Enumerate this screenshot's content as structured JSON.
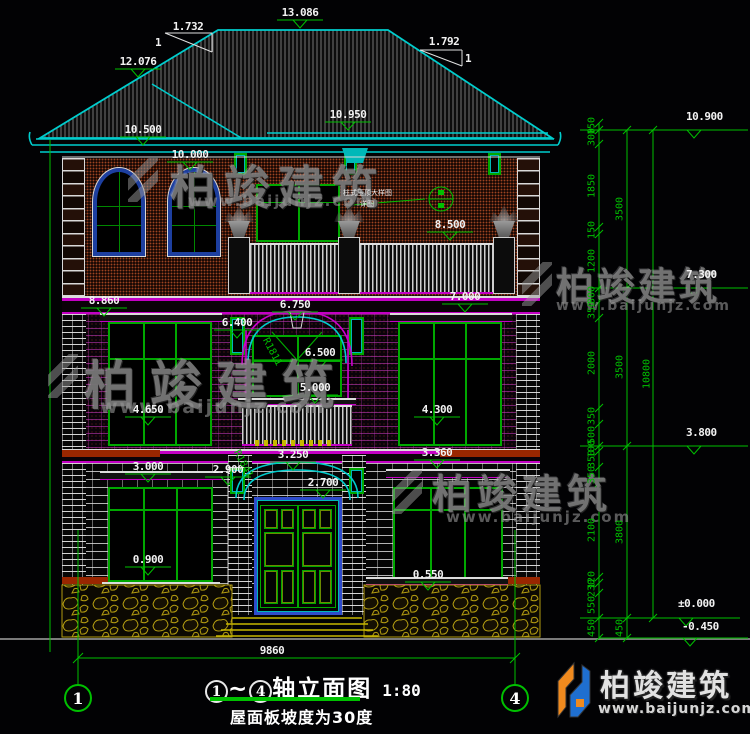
{
  "colors": {
    "cad_green": "#00c000",
    "cyan": "#00cdcd",
    "magenta": "#cc00cc",
    "window_green": "#00a800",
    "frame_blue": "#2e4bcc",
    "red_band": "#992600",
    "step_yellow": "#c8b800",
    "logo_blue": "#1f6fd0",
    "logo_orange": "#f08a1e"
  },
  "roof": {
    "slope_left_rise": "1.732",
    "slope_left_run": "1",
    "slope_right_rise": "1.792",
    "slope_right_run": "1"
  },
  "elevations": [
    {
      "label": "13.086",
      "x": 300,
      "y": 6
    },
    {
      "label": "12.076",
      "x": 138,
      "y": 55
    },
    {
      "label": "10.950",
      "x": 348,
      "y": 108
    },
    {
      "label": "10.500",
      "x": 143,
      "y": 123
    },
    {
      "label": "10.000",
      "x": 190,
      "y": 148
    },
    {
      "label": "8.500",
      "x": 450,
      "y": 218
    },
    {
      "label": "8.860",
      "x": 104,
      "y": 294
    },
    {
      "label": "6.750",
      "x": 295,
      "y": 298
    },
    {
      "label": "7.000",
      "x": 465,
      "y": 290
    },
    {
      "label": "6.400",
      "x": 237,
      "y": 316
    },
    {
      "label": "6.500",
      "x": 320,
      "y": 346
    },
    {
      "label": "5.000",
      "x": 315,
      "y": 381
    },
    {
      "label": "4.650",
      "x": 148,
      "y": 403
    },
    {
      "label": "4.300",
      "x": 437,
      "y": 403
    },
    {
      "label": "3.000",
      "x": 148,
      "y": 460
    },
    {
      "label": "2.900",
      "x": 228,
      "y": 463
    },
    {
      "label": "3.250",
      "x": 293,
      "y": 448
    },
    {
      "label": "2.700",
      "x": 323,
      "y": 476
    },
    {
      "label": "3.360",
      "x": 437,
      "y": 446
    },
    {
      "label": "0.900",
      "x": 148,
      "y": 553
    },
    {
      "label": "0.550",
      "x": 428,
      "y": 568
    }
  ],
  "right_levels": [
    {
      "label": "10.900",
      "x": 686,
      "y": 110,
      "ly": 130
    },
    {
      "label": "7.300",
      "x": 686,
      "y": 268,
      "ly": 288
    },
    {
      "label": "3.800",
      "x": 686,
      "y": 426,
      "ly": 446
    },
    {
      "label": "±0.000",
      "x": 678,
      "y": 597,
      "ly": 618
    },
    {
      "label": "-0.450",
      "x": 682,
      "y": 620,
      "ly": 638
    }
  ],
  "right_dims": {
    "col1": [
      [
        "150",
        126
      ],
      [
        "300",
        137
      ],
      [
        "1850",
        186
      ],
      [
        "150",
        230
      ],
      [
        "1200",
        261
      ],
      [
        "300",
        295
      ],
      [
        "350",
        310
      ],
      [
        "2000",
        363
      ],
      [
        "350",
        416
      ],
      [
        "500",
        435
      ],
      [
        "100",
        449
      ],
      [
        "350",
        459
      ],
      [
        "350",
        475
      ],
      [
        "2100",
        530
      ],
      [
        "120",
        580
      ],
      [
        "230",
        588
      ],
      [
        "550",
        605
      ],
      [
        "450",
        628
      ]
    ],
    "col2": [
      [
        "3500",
        209
      ],
      [
        "3500",
        367
      ],
      [
        "3800",
        532
      ],
      [
        "450",
        628
      ]
    ],
    "col3": [
      [
        "10800",
        374
      ]
    ]
  },
  "ticks": {
    "col1": [
      123,
      130,
      144,
      227,
      234,
      288,
      302,
      318,
      408,
      424,
      446,
      451,
      467,
      483,
      577,
      583,
      593,
      618,
      638
    ],
    "col2": [
      130,
      288,
      446,
      618,
      638
    ],
    "col3": [
      130,
      618
    ]
  },
  "radius_labels": [
    {
      "label": "R1811",
      "x": 272,
      "y": 352,
      "rot": 62
    },
    {
      "label": "R1841",
      "x": 243,
      "y": 464,
      "rot": 62
    }
  ],
  "slope_marks": {
    "left_rise": "1.732",
    "left_one": "1",
    "right_rise": "1.792",
    "right_one": "1"
  },
  "bottom": {
    "span": "9860"
  },
  "axis": {
    "left": "1",
    "right": "4"
  },
  "title": {
    "c1": "1",
    "tilde": "~",
    "c2": "4",
    "text": "轴立面图",
    "scale": "1:80",
    "sub": "屋面板坡度为30度"
  },
  "callout": {
    "line1": "柱式压顶大样图",
    "line2": "详图"
  },
  "watermarks": [
    {
      "text": "柏竣建筑",
      "x": 170,
      "y": 152,
      "size": 46,
      "ls": 8,
      "url": "www.baijunjz.com",
      "ux": 188,
      "uy": 192,
      "us": 15,
      "mx": 128,
      "my": 158
    },
    {
      "text": "柏竣建筑",
      "x": 84,
      "y": 344,
      "size": 52,
      "ls": 14,
      "url": "www.baijunjz.com",
      "ux": 100,
      "uy": 396,
      "us": 19,
      "mx": 48,
      "my": 354
    },
    {
      "text": "柏竣建筑",
      "x": 556,
      "y": 256,
      "size": 38,
      "ls": 3,
      "url": "www.baijunjz.com",
      "ux": 556,
      "uy": 298,
      "us": 14,
      "mx": 522,
      "my": 262
    },
    {
      "text": "柏竣建筑",
      "x": 432,
      "y": 462,
      "size": 40,
      "ls": 5,
      "url": "www.baijunjz.com",
      "ux": 446,
      "uy": 508,
      "us": 15,
      "mx": 392,
      "my": 470
    }
  ],
  "brand": {
    "name": "柏竣建筑",
    "url": "www.baijunjz.com"
  }
}
